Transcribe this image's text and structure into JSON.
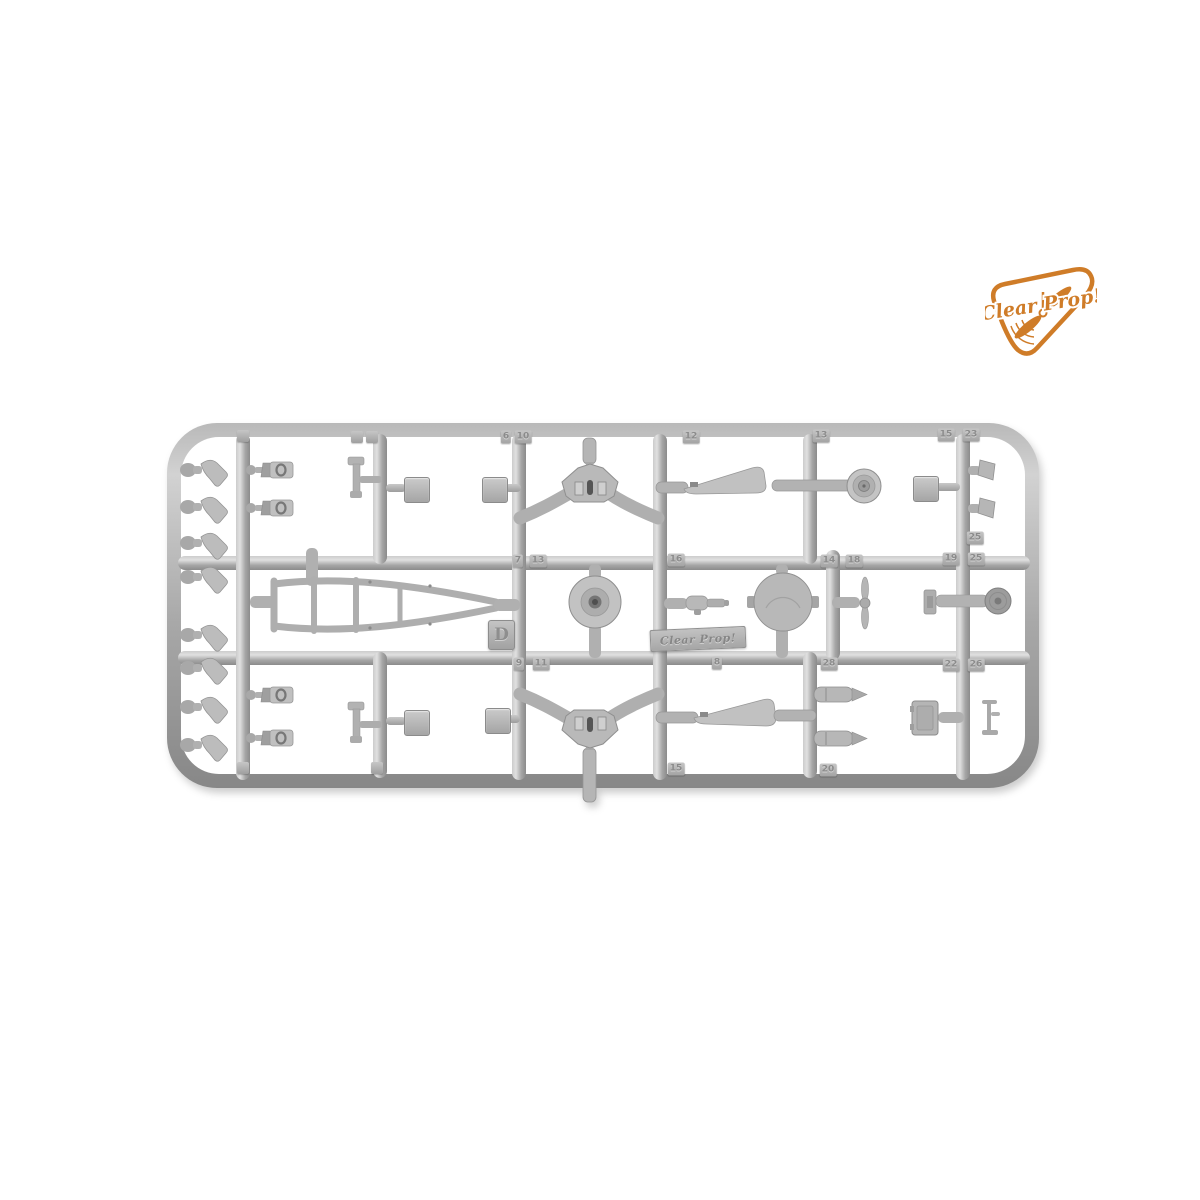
{
  "scene": {
    "background": "#ffffff",
    "description": "Product photo of a grey injection-molded model kit parts sprue (runner D) on a white background with the Clear Prop! brand logo in the top right corner"
  },
  "logo": {
    "text": "Clear Prop!",
    "color": "#cf7c28"
  },
  "sprue": {
    "id_letter": "D",
    "brand_plate_text": "Clear Prop!",
    "plastic_base_color": "#a6a6a6",
    "plastic_light_color": "#dedede",
    "plastic_dark_color": "#8a8a8a",
    "part_number_tags": [
      {
        "label": "6",
        "x": 506,
        "y": 437
      },
      {
        "label": "10",
        "x": 523,
        "y": 437
      },
      {
        "label": "12",
        "x": 691,
        "y": 437
      },
      {
        "label": "13",
        "x": 821,
        "y": 436
      },
      {
        "label": "15",
        "x": 946,
        "y": 435
      },
      {
        "label": "23",
        "x": 971,
        "y": 435
      },
      {
        "label": "25",
        "x": 975,
        "y": 538
      },
      {
        "label": "7",
        "x": 518,
        "y": 561
      },
      {
        "label": "13",
        "x": 538,
        "y": 561
      },
      {
        "label": "16",
        "x": 676,
        "y": 560
      },
      {
        "label": "14",
        "x": 829,
        "y": 561
      },
      {
        "label": "18",
        "x": 854,
        "y": 561
      },
      {
        "label": "19",
        "x": 951,
        "y": 559
      },
      {
        "label": "25",
        "x": 976,
        "y": 559
      },
      {
        "label": "9",
        "x": 519,
        "y": 664
      },
      {
        "label": "11",
        "x": 541,
        "y": 664
      },
      {
        "label": "8",
        "x": 717,
        "y": 663
      },
      {
        "label": "28",
        "x": 829,
        "y": 664
      },
      {
        "label": "22",
        "x": 951,
        "y": 665
      },
      {
        "label": "26",
        "x": 976,
        "y": 665
      },
      {
        "label": "15",
        "x": 676,
        "y": 769
      },
      {
        "label": "20",
        "x": 828,
        "y": 770
      }
    ],
    "blank_tabs": [
      {
        "x": 243,
        "y": 436
      },
      {
        "x": 357,
        "y": 437
      },
      {
        "x": 372,
        "y": 437
      },
      {
        "x": 243,
        "y": 768
      },
      {
        "x": 377,
        "y": 768
      }
    ]
  }
}
